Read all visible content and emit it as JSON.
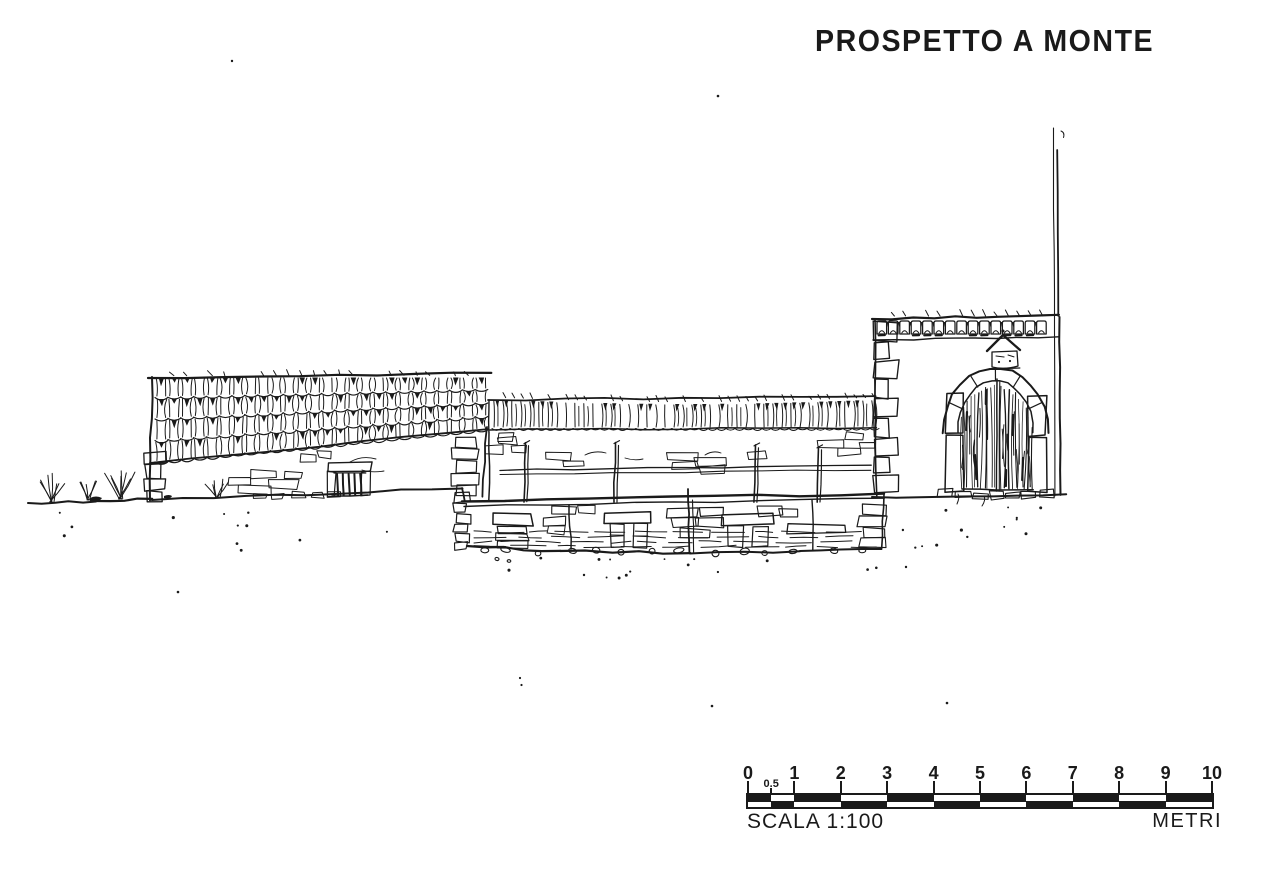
{
  "title": "PROSPETTO A MONTE",
  "colors": {
    "ink": "#1a1a1a",
    "paper": "#ffffff"
  },
  "scale_bar": {
    "scale_label": "SCALA 1:100",
    "unit_label": "METRI",
    "ticks": [
      {
        "label": "0",
        "m": 0
      },
      {
        "label": "0.5",
        "m": 0.5,
        "small": true
      },
      {
        "label": "1",
        "m": 1
      },
      {
        "label": "2",
        "m": 2
      },
      {
        "label": "3",
        "m": 3
      },
      {
        "label": "4",
        "m": 4
      },
      {
        "label": "5",
        "m": 5
      },
      {
        "label": "6",
        "m": 6
      },
      {
        "label": "7",
        "m": 7
      },
      {
        "label": "8",
        "m": 8
      },
      {
        "label": "9",
        "m": 9
      },
      {
        "label": "10",
        "m": 10
      }
    ]
  },
  "drawing": {
    "elements": [
      "left-barn-with-tiled-roof",
      "barred-ground-window",
      "middle-terrace-with-wooden-fence",
      "stone-retaining-wall",
      "right-building-with-arched-portal",
      "stone-arch-surround",
      "wooden-double-door",
      "wall-shrine-crest",
      "thin-pole",
      "ground-line-with-grass"
    ]
  }
}
